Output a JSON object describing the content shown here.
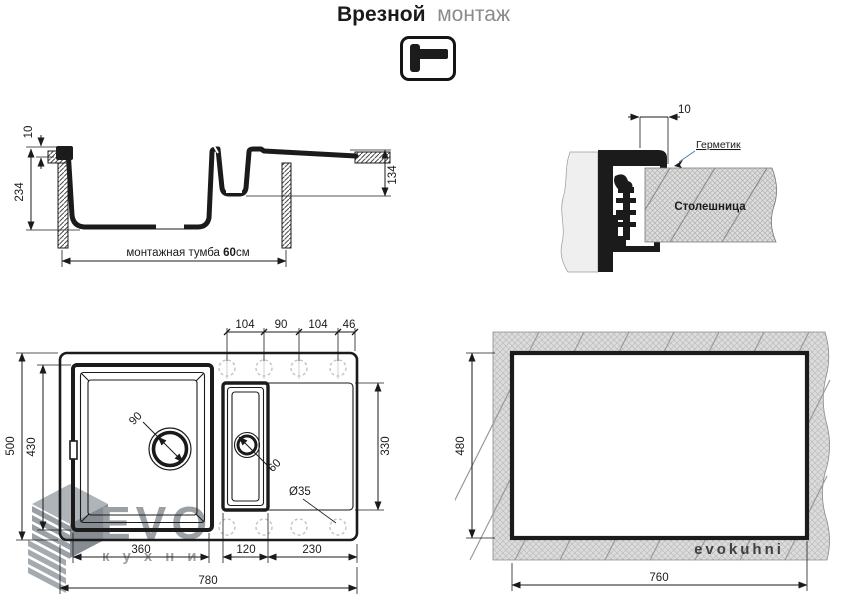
{
  "title": {
    "bold": "Врезной",
    "light": "монтаж"
  },
  "section_view": {
    "dim_overhang": "10",
    "dim_depth": "234",
    "dim_right_depth": "134",
    "cabinet_prefix": "монтажная тумба ",
    "cabinet_bold": "60",
    "cabinet_suffix": "см"
  },
  "detail_view": {
    "dim_gap": "10",
    "sealant": "Герметик",
    "countertop": "Столешница"
  },
  "top_view": {
    "dims_top": [
      "104",
      "90",
      "104",
      "46"
    ],
    "dim_outer_height": "500",
    "dim_bowl_height": "430",
    "dim_right_height": "330",
    "dims_bottom": [
      "360",
      "120",
      "230"
    ],
    "dim_outer_width": "780",
    "drain_main": "90",
    "drain_small": "60",
    "tap_hole": "Ø35"
  },
  "cutout_view": {
    "dim_height": "480",
    "dim_width": "760",
    "watermark": "evokuhni"
  },
  "logo": {
    "brand": "EVO",
    "letters": [
      "к",
      "у",
      "х",
      "н",
      "и"
    ]
  },
  "colors": {
    "drawing_black": "#1b1b1b",
    "muted_gray": "#8a8a8a",
    "accent_blue": "#4272a8",
    "logo_gray": "#9ba0a5",
    "hatch_gray": "#dcdcdc"
  }
}
